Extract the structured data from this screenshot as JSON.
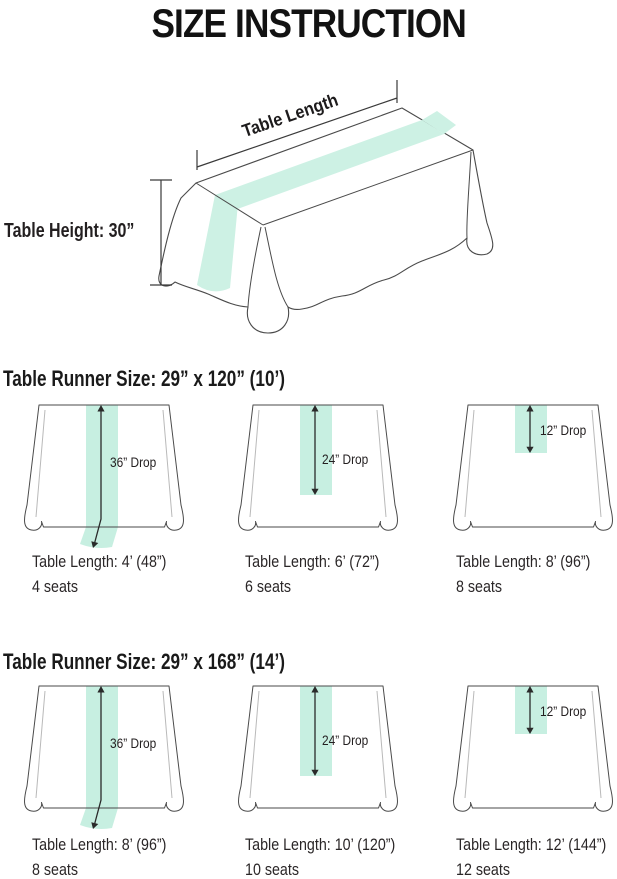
{
  "title": "SIZE INSTRUCTION",
  "top_diagram": {
    "length_label": "Table Length",
    "height_label": "Table Height: 30”"
  },
  "sections": [
    {
      "heading": "Table Runner Size: 29” x 120” (10’)",
      "tables": [
        {
          "drop": "36” Drop",
          "length": "Table Length: 4’ (48”)",
          "seats": "4 seats"
        },
        {
          "drop": "24” Drop",
          "length": "Table Length: 6’ (72”)",
          "seats": "6 seats"
        },
        {
          "drop": "12” Drop",
          "length": "Table Length: 8’ (96”)",
          "seats": "8 seats"
        }
      ]
    },
    {
      "heading": "Table Runner Size: 29” x 168” (14’)",
      "tables": [
        {
          "drop": "36” Drop",
          "length": "Table Length: 8’ (96”)",
          "seats": "8 seats"
        },
        {
          "drop": "24” Drop",
          "length": "Table Length: 10’ (120”)",
          "seats": "10 seats"
        },
        {
          "drop": "12” Drop",
          "length": "Table Length: 12’ (144”)",
          "seats": "12 seats"
        }
      ]
    }
  ],
  "colors": {
    "runner_mint": "#c7efe1",
    "outline": "#4a4a4a",
    "text": "#231f20"
  }
}
